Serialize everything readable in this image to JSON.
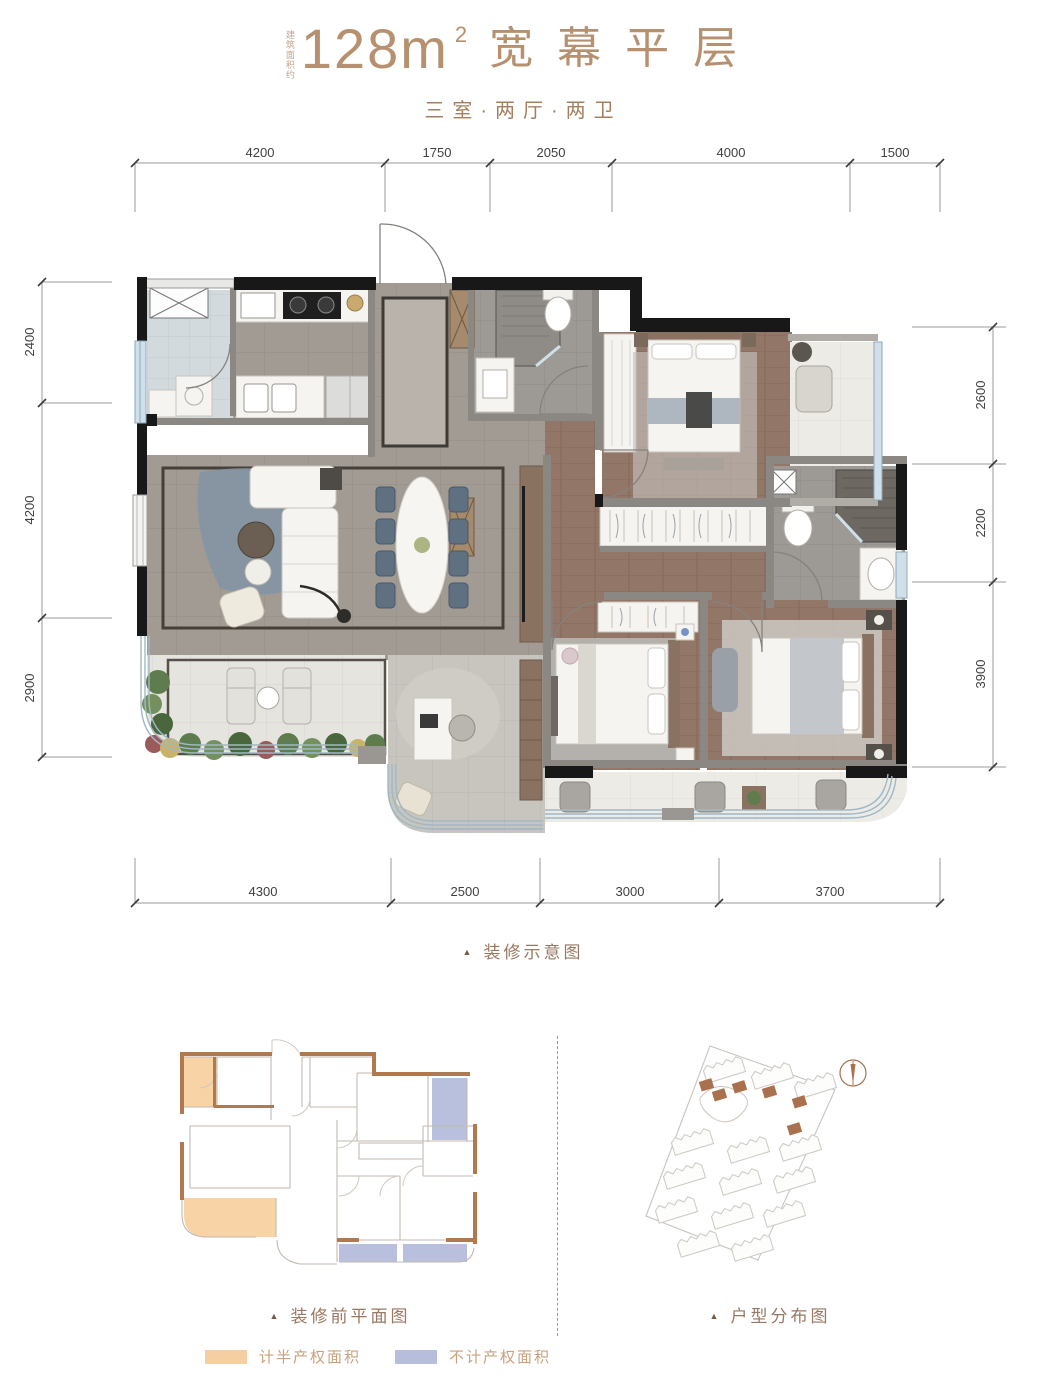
{
  "header": {
    "area_note": "建筑面积约",
    "area_value": "128m",
    "area_exponent": "2",
    "title": "宽幕平层",
    "subtitle": "三室·两厅·两卫"
  },
  "dimensions": {
    "top": [
      "4200",
      "1750",
      "2050",
      "4000",
      "1500"
    ],
    "bottom": [
      "4300",
      "2500",
      "3000",
      "3700"
    ],
    "left": [
      "2400",
      "4200",
      "2900"
    ],
    "right": [
      "2600",
      "2200",
      "3900"
    ]
  },
  "captions": {
    "main_plan": "装修示意图",
    "pre_plan": "装修前平面图",
    "site_plan": "户型分布图"
  },
  "legend": {
    "half_property": {
      "label": "计半产权面积",
      "color": "#f5cfa2"
    },
    "excluded": {
      "label": "不计产权面积",
      "color": "#b7bedb"
    }
  },
  "icons": {
    "triangle_marker": "▲"
  },
  "colors": {
    "title_brown": "#b6906f",
    "caption_brown": "#9a7760",
    "wall_black": "#181818",
    "tile_grey": "#a19b94",
    "wood_floor": "#927768",
    "glazing_blue": "#cfe0ea",
    "outline_brown": "#b07a4e"
  }
}
